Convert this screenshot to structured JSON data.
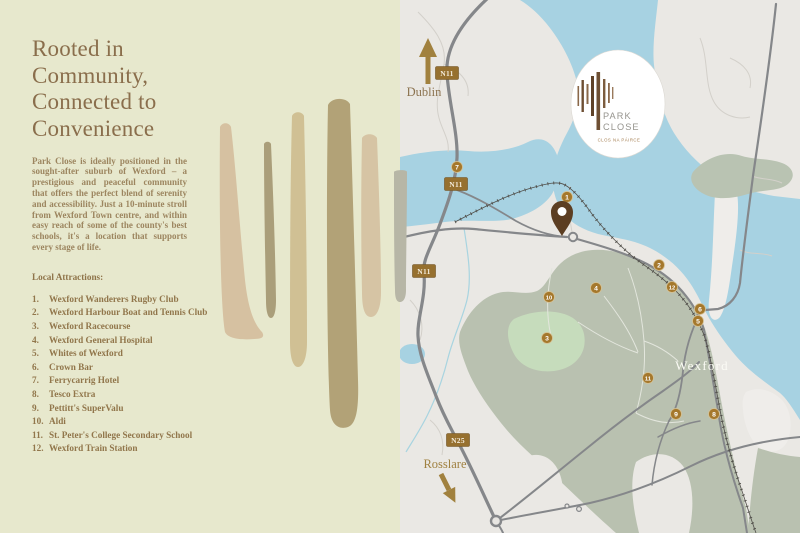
{
  "brand": {
    "name_line1": "PARK",
    "name_line2": "CLOSE",
    "subtitle": "CLOS NA PÁIRCE"
  },
  "left_panel": {
    "heading": "Rooted in Community, Connected to Convenience",
    "body": "Park Close is ideally positioned in the sought-after suburb of Wexford – a prestigious and peaceful community that offers the perfect blend of serenity and accessibility. Just a 10-minute stroll from Wexford Town centre, and within easy reach of some of the county's best schools, it's a location that supports every stage of life.",
    "attractions_label": "Local Attractions:",
    "attractions": [
      {
        "num": "1.",
        "name": "Wexford Wanderers Rugby Club"
      },
      {
        "num": "2.",
        "name": "Wexford Harbour Boat and Tennis Club"
      },
      {
        "num": "3.",
        "name": "Wexford Racecourse"
      },
      {
        "num": "4.",
        "name": "Wexford General Hospital"
      },
      {
        "num": "5.",
        "name": "Whites of Wexford"
      },
      {
        "num": "6.",
        "name": "Crown Bar"
      },
      {
        "num": "7.",
        "name": "Ferrycarrig Hotel"
      },
      {
        "num": "8.",
        "name": "Tesco Extra"
      },
      {
        "num": "9.",
        "name": "Pettitt's SuperValu"
      },
      {
        "num": "10.",
        "name": "Aldi"
      },
      {
        "num": "11.",
        "name": "St. Peter's College Secondary School"
      },
      {
        "num": "12.",
        "name": "Wexford Train Station"
      }
    ]
  },
  "map": {
    "labels": {
      "north_city": "Dublin",
      "south_city": "Rosslare",
      "town": "Wexford"
    },
    "road_badges": [
      {
        "label": "N11",
        "x": 47,
        "y": 73
      },
      {
        "label": "N11",
        "x": 56,
        "y": 184
      },
      {
        "label": "N11",
        "x": 24,
        "y": 271
      },
      {
        "label": "N25",
        "x": 58,
        "y": 440
      }
    ],
    "markers": [
      {
        "num": "1",
        "x": 167,
        "y": 197
      },
      {
        "num": "2",
        "x": 259,
        "y": 265
      },
      {
        "num": "3",
        "x": 147,
        "y": 338
      },
      {
        "num": "4",
        "x": 196,
        "y": 288
      },
      {
        "num": "5",
        "x": 298,
        "y": 321
      },
      {
        "num": "6",
        "x": 300,
        "y": 309
      },
      {
        "num": "7",
        "x": 57,
        "y": 167
      },
      {
        "num": "8",
        "x": 314,
        "y": 414
      },
      {
        "num": "9",
        "x": 276,
        "y": 414
      },
      {
        "num": "10",
        "x": 149,
        "y": 297
      },
      {
        "num": "11",
        "x": 248,
        "y": 378
      },
      {
        "num": "12",
        "x": 272,
        "y": 287
      }
    ],
    "colors": {
      "water": "#a7d2e2",
      "land": "#eae8e4",
      "town": "#b9c1b0",
      "green": "#c6dcbc",
      "marker": "#a5782c",
      "badge": "#96702f",
      "accent": "#a1813e",
      "pin": "#5c3e22"
    }
  }
}
